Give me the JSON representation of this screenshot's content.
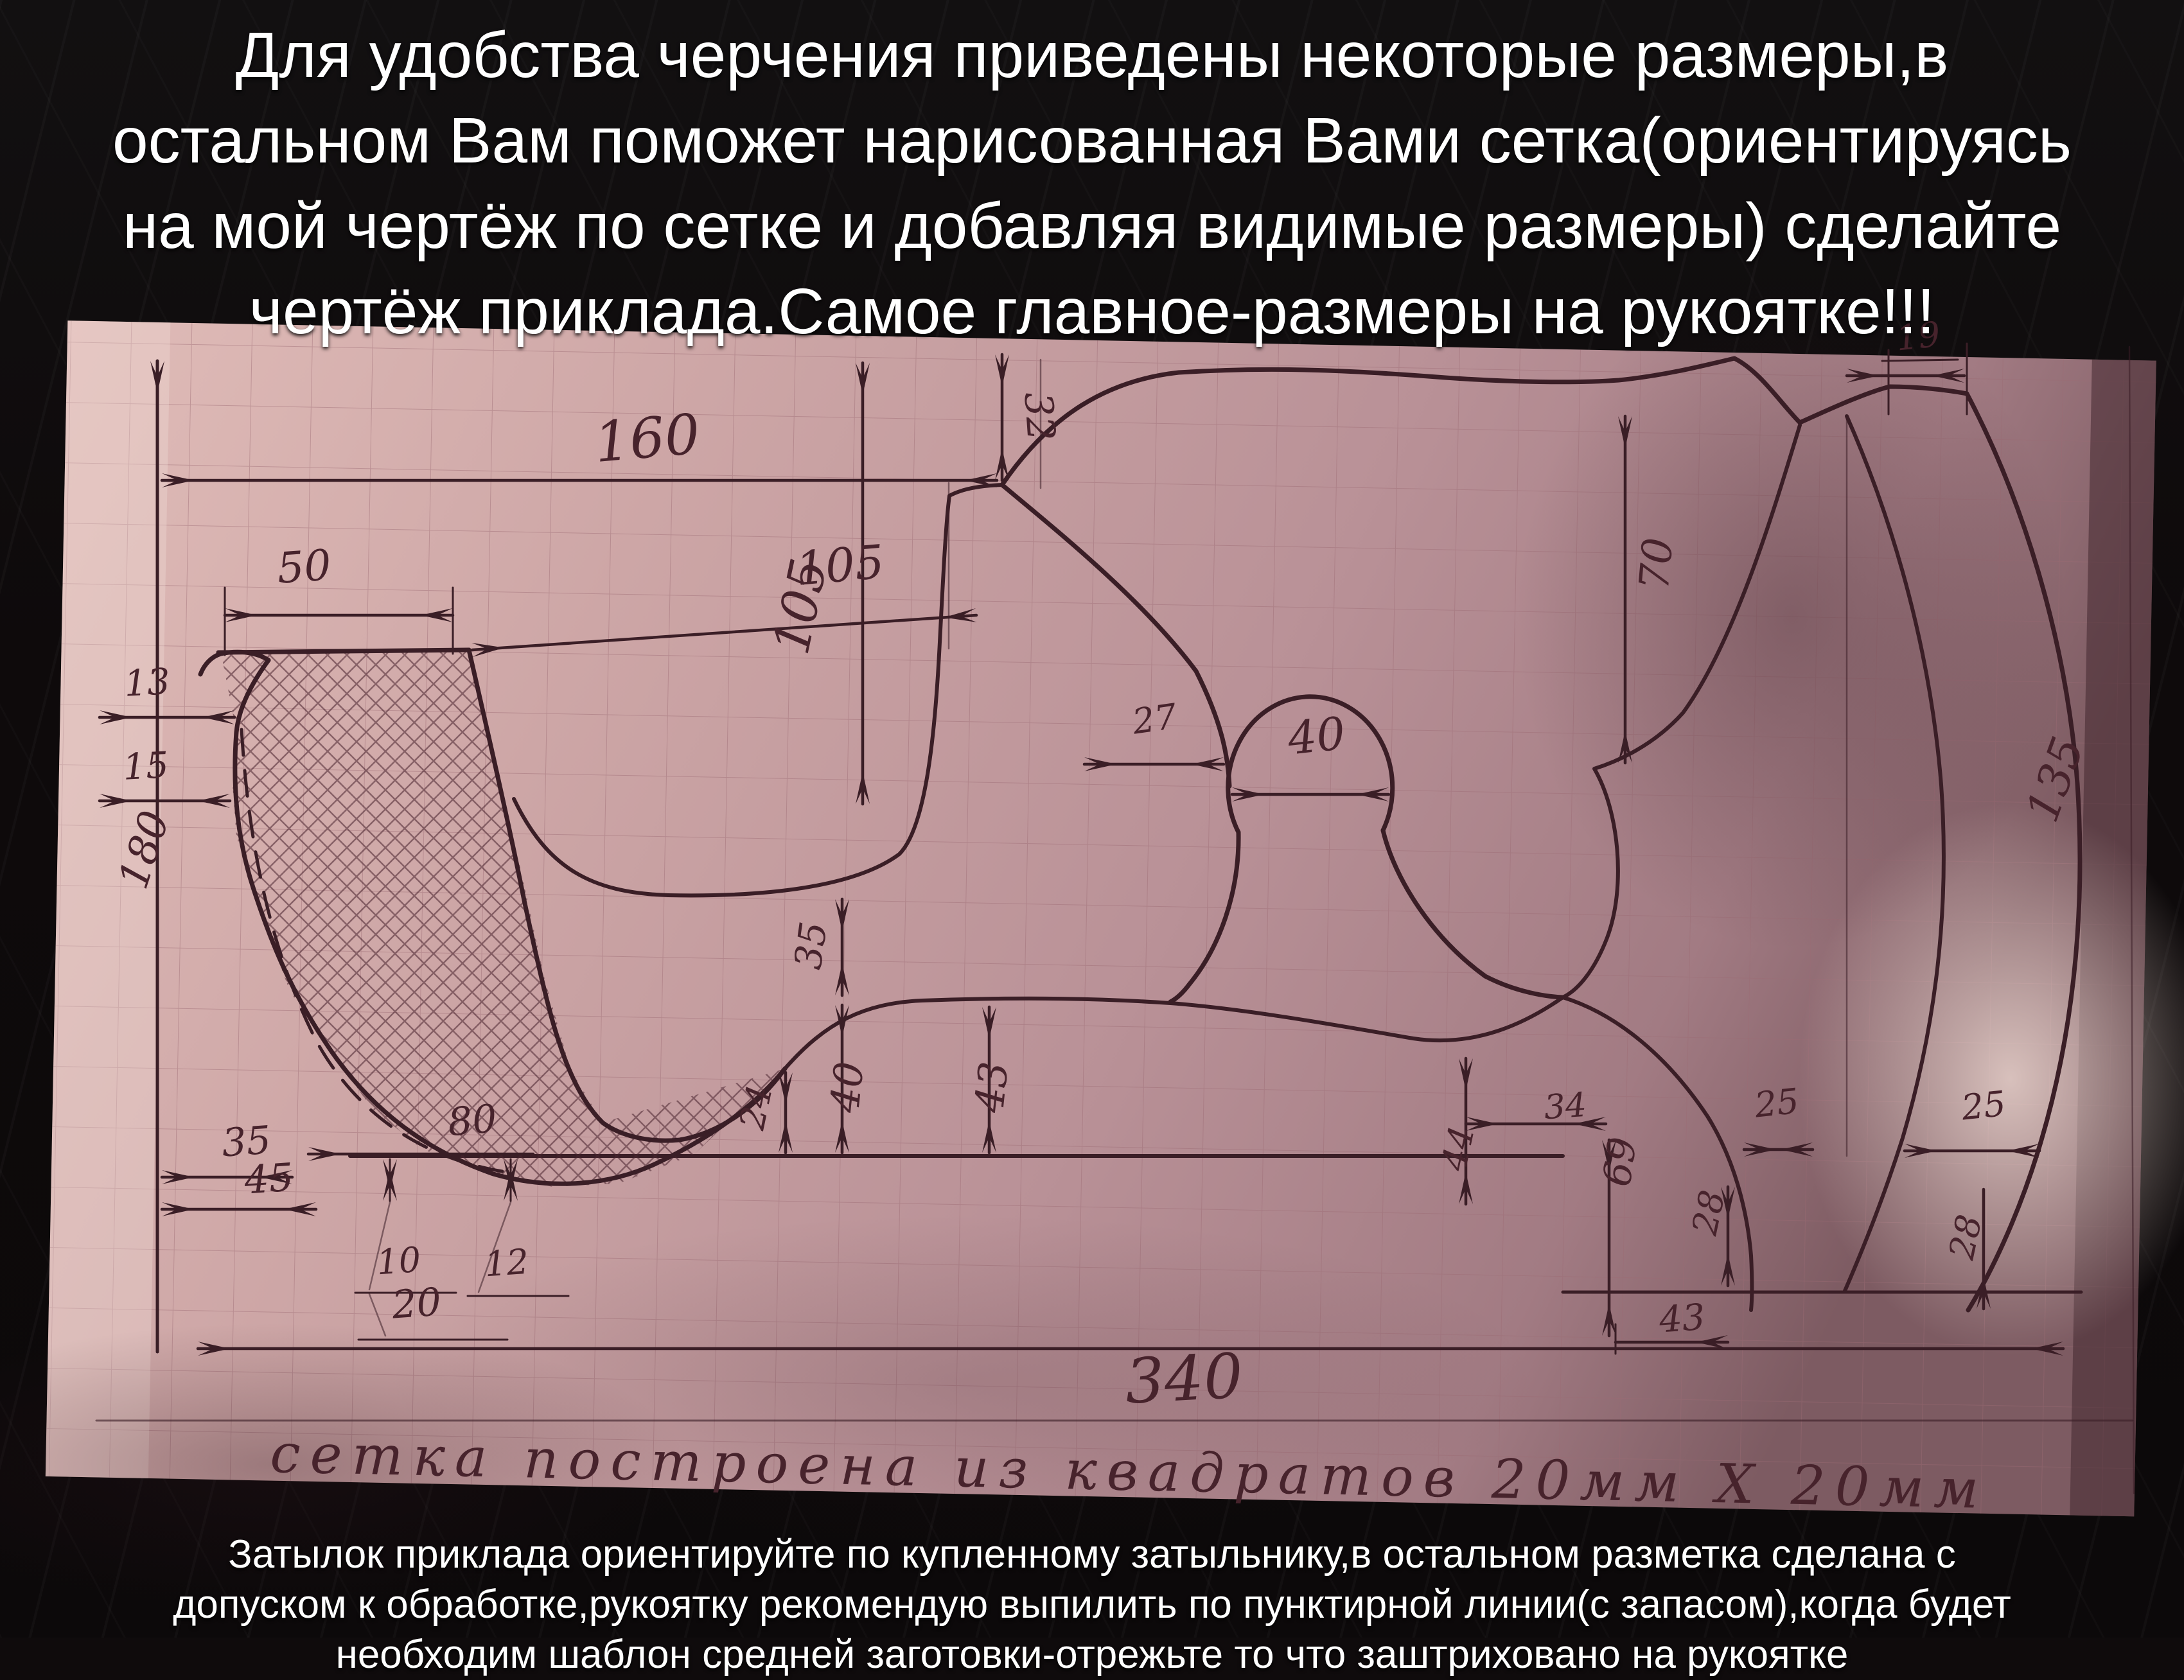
{
  "title_overlay": {
    "lines": [
      "Для удобства черчения приведены некоторые размеры,в",
      "остальном Вам поможет нарисованная Вами сетка(ориентируясь",
      "на мой чертёж по сетке и добавляя видимые размеры) сделайте",
      "чертёж приклада.Самое главное-размеры на рукоятке!!!"
    ]
  },
  "bottom_overlay": {
    "lines": [
      "Затылок приклада ориентируйте по купленному затыльнику,в остальном разметка сделана с",
      "допуском к обработке,рукоятку рекомендую выпилить по пунктирной линии(с запасом),когда будет",
      "необходим шаблон средней заготовки-отрежьте то что заштриховано на рукоятке"
    ]
  },
  "drawing": {
    "caption": "сетка построена из квадратов 20мм Х 20мм",
    "grid_square": "20мм Х 20мм",
    "labels": {
      "d160": "160",
      "d50": "50",
      "d13": "13",
      "d15": "15",
      "d180": "180",
      "d32": "32",
      "d105v": "105",
      "d105h": "105",
      "d27": "27",
      "d40c": "40",
      "d70": "70",
      "d19": "19",
      "d135": "135",
      "d35a": "35",
      "d40b": "40",
      "d43a": "43",
      "d24": "24",
      "d35b": "35",
      "d45": "45",
      "d80": "80",
      "d10": "10",
      "d20": "20",
      "d12": "12",
      "d340": "340",
      "d34": "34",
      "d44": "44",
      "d69": "69",
      "d43b": "43",
      "d25a": "25",
      "d25b": "25",
      "d28a": "28",
      "d28b": "28"
    },
    "colors": {
      "background": "#0f0b0c",
      "paper": "#cda6a6",
      "ink": "#3a1e26",
      "grid": "#9b6b74",
      "overlay_text": "#ffffff"
    }
  }
}
